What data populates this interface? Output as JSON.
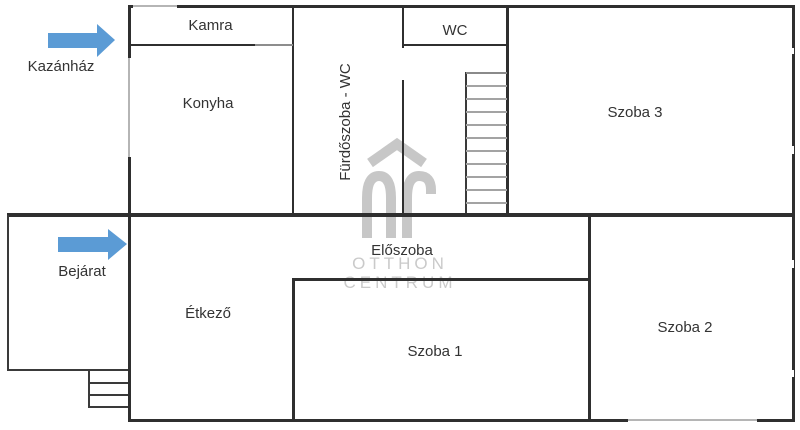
{
  "rooms": {
    "kamra": "Kamra",
    "konyha": "Konyha",
    "furdoszoba": "Fürdőszoba - WC",
    "wc": "WC",
    "szoba3": "Szoba 3",
    "eloszoba": "Előszoba",
    "etkezo": "Étkező",
    "szoba1": "Szoba 1",
    "szoba2": "Szoba 2"
  },
  "annotations": {
    "kazanhaz": "Kazánház",
    "bejarat": "Bejárat"
  },
  "watermark": {
    "line1": "OTTHON",
    "line2": "CENTRUM"
  },
  "colors": {
    "wall": "#2f2f2f",
    "light_wall": "#b5b5b5",
    "stair_tread": "#a3a3a3",
    "arrow_blue": "#5b9bd5",
    "watermark_gray": "#c7c7c7",
    "label_text": "#333333"
  }
}
